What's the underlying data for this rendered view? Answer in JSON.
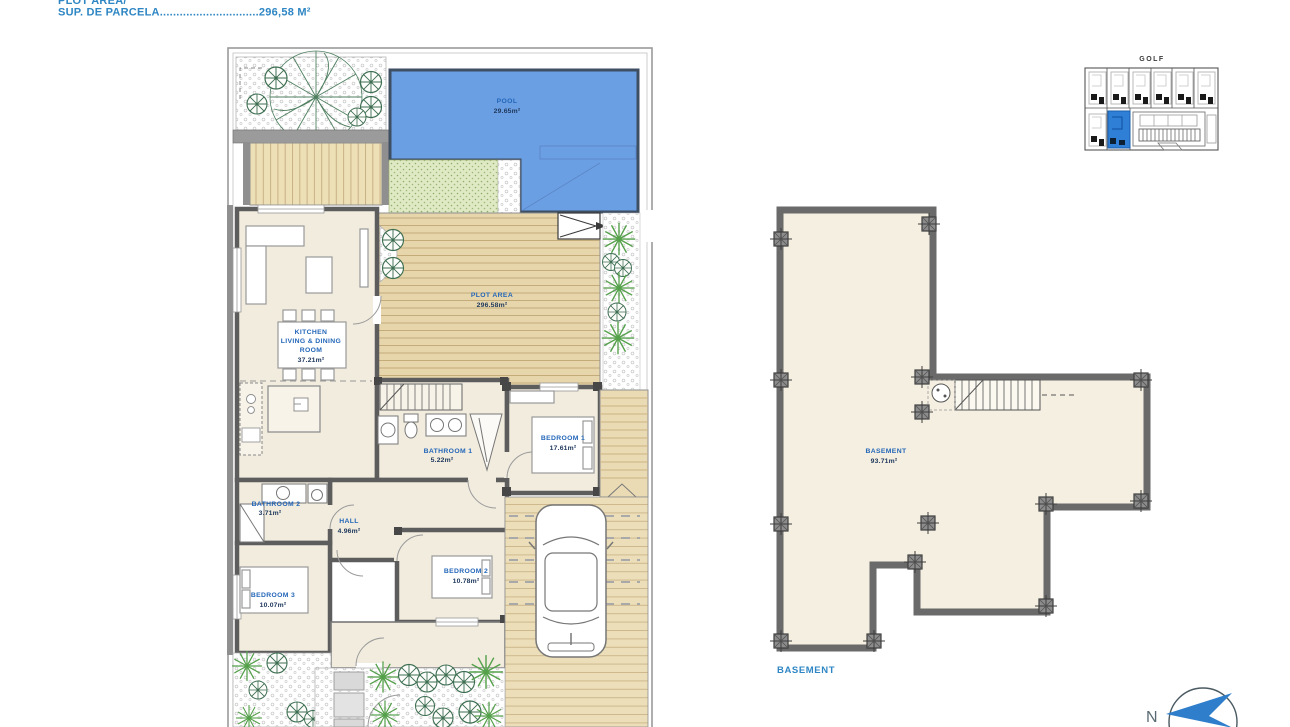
{
  "header": {
    "line1": "PLOT AREA/",
    "line2": "SUP. DE PARCELA..............................296,58 M²"
  },
  "site_map": {
    "title": "GOLF"
  },
  "plan": {
    "pool": {
      "name": "POOL",
      "area": "29.65m²"
    },
    "plot": {
      "name": "PLOT AREA",
      "area": "296.58m²"
    },
    "kitchen": {
      "l1": "KITCHEN",
      "l2": "LIVING  &  DINING",
      "l3": "ROOM",
      "area": "37.21m²"
    },
    "bathroom1": {
      "name": "BATHROOM 1",
      "area": "5.22m²"
    },
    "bedroom1": {
      "name": "BEDROOM  1",
      "area": "17.61m²"
    },
    "bathroom2": {
      "name": "BATHROOM  2",
      "area": "3.71m²"
    },
    "hall": {
      "name": "HALL",
      "area": "4.96m²"
    },
    "bedroom2": {
      "name": "BEDROOM  2",
      "area": "10.78m²"
    },
    "bedroom3": {
      "name": "BEDROOM  3",
      "area": "10.07m²"
    }
  },
  "basement": {
    "name": "BASEMENT",
    "area": "93.71m²",
    "caption": "BASEMENT"
  },
  "compass": {
    "label": "N"
  },
  "colors": {
    "accent_blue": "#2366b8",
    "title_blue": "#2e86c4",
    "pool_blue": "#6b9fe3",
    "wall_gray": "#5d5d5d",
    "floor_beige": "#f1ecde",
    "deck_tan": "#e7d6ac",
    "grass_green": "#dfe9c4",
    "highlight_unit_blue": "#2f7fd6"
  }
}
